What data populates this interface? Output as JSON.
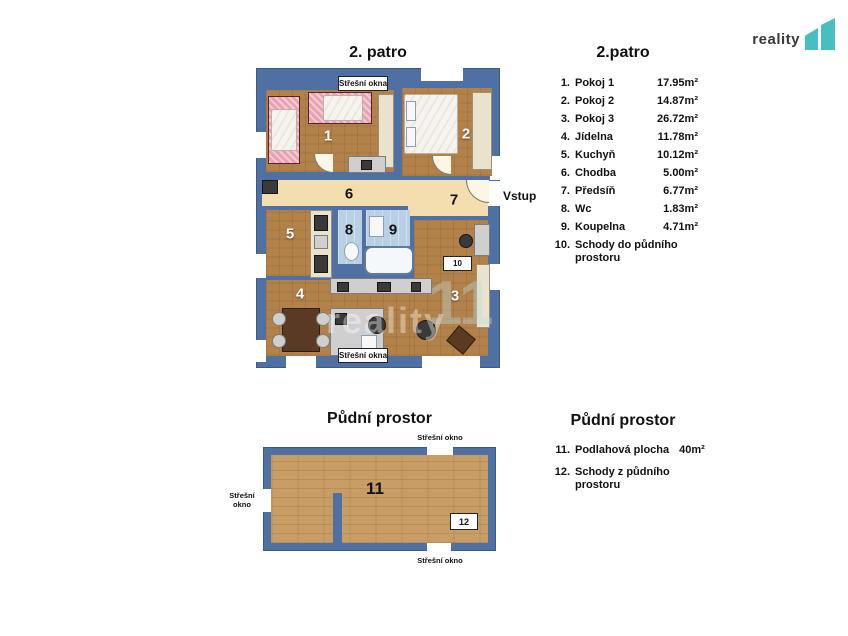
{
  "logo": {
    "text": "reality",
    "numeral": "11"
  },
  "upper_floor": {
    "plan_title": "2. patro",
    "legend_title": "2.patro",
    "entrance_label": "Vstup",
    "roof_windows_top_label": "Střešní okna",
    "roof_windows_bottom_label": "Střešní okna",
    "stairs_box_label": "10",
    "rooms": [
      {
        "num": "1.",
        "short": "1",
        "name": "Pokoj 1",
        "area": "17.95m²"
      },
      {
        "num": "2.",
        "short": "2",
        "name": "Pokoj 2",
        "area": "14.87m²"
      },
      {
        "num": "3.",
        "short": "3",
        "name": "Pokoj 3",
        "area": "26.72m²"
      },
      {
        "num": "4.",
        "short": "4",
        "name": "Jídelna",
        "area": "11.78m²"
      },
      {
        "num": "5.",
        "short": "5",
        "name": "Kuchyň",
        "area": "10.12m²"
      },
      {
        "num": "6.",
        "short": "6",
        "name": "Chodba",
        "area": "5.00m²"
      },
      {
        "num": "7.",
        "short": "7",
        "name": "Předsíň",
        "area": "6.77m²"
      },
      {
        "num": "8.",
        "short": "8",
        "name": "Wc",
        "area": "1.83m²"
      },
      {
        "num": "9.",
        "short": "9",
        "name": "Koupelna",
        "area": "4.71m²"
      },
      {
        "num": "10.",
        "short": "10",
        "name": "Schody do půdního prostoru",
        "area": ""
      }
    ]
  },
  "attic": {
    "plan_title": "Půdní prostor",
    "legend_title": "Půdní prostor",
    "roof_window_top_label": "Střešní okno",
    "roof_window_left_line1": "Střešní",
    "roof_window_left_line2": "okno",
    "roof_window_bottom_label": "Střešní okno",
    "floor_number": "11",
    "stairs_box_label": "12",
    "rooms": [
      {
        "num": "11.",
        "name": "Podlahová plocha",
        "area": "40m²"
      },
      {
        "num": "12.",
        "name": "Schody z půdního prostoru",
        "area": ""
      }
    ]
  },
  "watermark": {
    "text": "reality",
    "numeral": "11"
  },
  "colors": {
    "wall": "#4e70a2",
    "wood": "#b2824a",
    "wood_light": "#c99d66",
    "corridor": "#f4deb0",
    "tile": "#b9cfe4",
    "accent": "#45bfc0"
  }
}
